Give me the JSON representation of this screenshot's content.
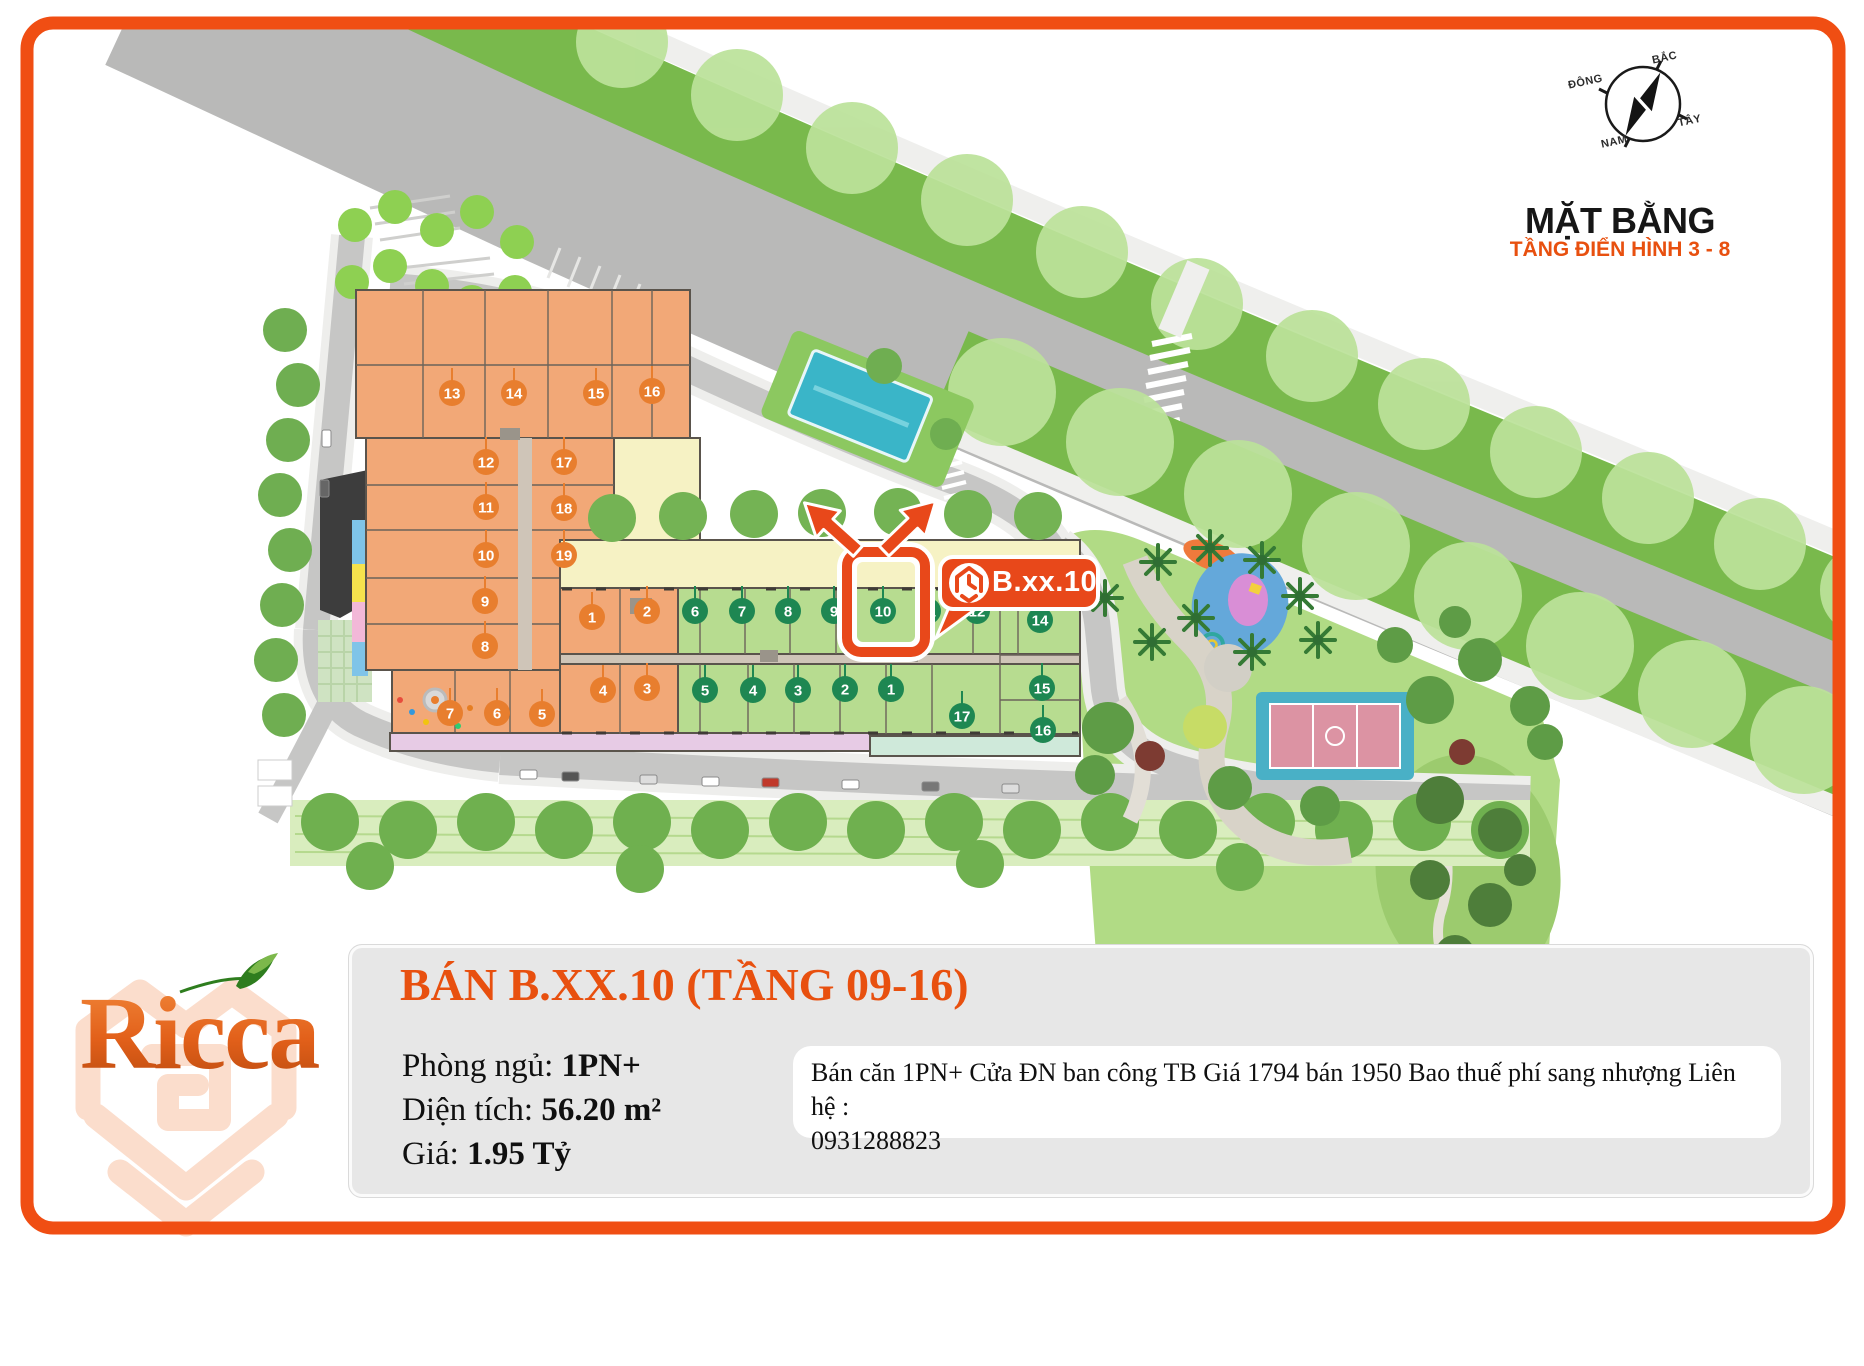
{
  "border_color": "#F04E13",
  "accent_color": "#E8500F",
  "compass": {
    "north": "BẮC",
    "east": "ĐÔNG",
    "west": "TÂY",
    "south": "NAM"
  },
  "plan": {
    "title": "MẶT BẰNG",
    "subtitle": "TẦNG ĐIỂN HÌNH 3 - 8",
    "callout_label": "B.xx.10",
    "colors": {
      "green_badge": "#1E8752",
      "orange_badge": "#E87E2E",
      "green_unit": "#B7DC90",
      "orange_unit": "#F2A877",
      "highlight": "#E8481A"
    },
    "units": [
      {
        "n": "13",
        "x": 452,
        "y": 393,
        "c": "o"
      },
      {
        "n": "14",
        "x": 514,
        "y": 393,
        "c": "o"
      },
      {
        "n": "15",
        "x": 596,
        "y": 393,
        "c": "o"
      },
      {
        "n": "16",
        "x": 652,
        "y": 391,
        "c": "o"
      },
      {
        "n": "12",
        "x": 486,
        "y": 462,
        "c": "o"
      },
      {
        "n": "17",
        "x": 564,
        "y": 462,
        "c": "o"
      },
      {
        "n": "11",
        "x": 486,
        "y": 507,
        "c": "o"
      },
      {
        "n": "18",
        "x": 564,
        "y": 508,
        "c": "o"
      },
      {
        "n": "10",
        "x": 486,
        "y": 555,
        "c": "o"
      },
      {
        "n": "19",
        "x": 564,
        "y": 555,
        "c": "o"
      },
      {
        "n": "9",
        "x": 485,
        "y": 601,
        "c": "o"
      },
      {
        "n": "8",
        "x": 485,
        "y": 646,
        "c": "o"
      },
      {
        "n": "7",
        "x": 450,
        "y": 713,
        "c": "o"
      },
      {
        "n": "6",
        "x": 497,
        "y": 713,
        "c": "o"
      },
      {
        "n": "5",
        "x": 542,
        "y": 714,
        "c": "o"
      },
      {
        "n": "1",
        "x": 592,
        "y": 617,
        "c": "o"
      },
      {
        "n": "2",
        "x": 647,
        "y": 611,
        "c": "o"
      },
      {
        "n": "4",
        "x": 603,
        "y": 690,
        "c": "o"
      },
      {
        "n": "3",
        "x": 647,
        "y": 688,
        "c": "o"
      },
      {
        "n": "6",
        "x": 695,
        "y": 611,
        "c": "g"
      },
      {
        "n": "7",
        "x": 742,
        "y": 611,
        "c": "g"
      },
      {
        "n": "8",
        "x": 788,
        "y": 611,
        "c": "g"
      },
      {
        "n": "9",
        "x": 834,
        "y": 611,
        "c": "g"
      },
      {
        "n": "10",
        "x": 883,
        "y": 611,
        "c": "g"
      },
      {
        "n": "11",
        "x": 928,
        "y": 611,
        "c": "g"
      },
      {
        "n": "12",
        "x": 977,
        "y": 611,
        "c": "g"
      },
      {
        "n": "14",
        "x": 1040,
        "y": 620,
        "c": "g"
      },
      {
        "n": "5",
        "x": 705,
        "y": 690,
        "c": "g"
      },
      {
        "n": "4",
        "x": 753,
        "y": 690,
        "c": "g"
      },
      {
        "n": "3",
        "x": 798,
        "y": 690,
        "c": "g"
      },
      {
        "n": "2",
        "x": 845,
        "y": 689,
        "c": "g"
      },
      {
        "n": "1",
        "x": 891,
        "y": 689,
        "c": "g"
      },
      {
        "n": "15",
        "x": 1042,
        "y": 688,
        "c": "g"
      },
      {
        "n": "16",
        "x": 1043,
        "y": 730,
        "c": "g"
      },
      {
        "n": "17",
        "x": 962,
        "y": 716,
        "c": "g"
      }
    ]
  },
  "listing": {
    "title": "BÁN B.XX.10 (TẦNG 09-16)",
    "bedrooms_label": "Phòng ngủ: ",
    "bedrooms_value": "1PN+",
    "area_label": "Diện tích: ",
    "area_value": "56.20 m²",
    "price_label": "Giá: ",
    "price_value": "1.95 Tỷ",
    "description": "Bán căn 1PN+ Cửa ĐN ban công TB Giá 1794 bán 1950 Bao thuế phí sang nhượng Liên hệ :",
    "phone": "0931288823"
  },
  "logo": {
    "text": "Ricca"
  }
}
